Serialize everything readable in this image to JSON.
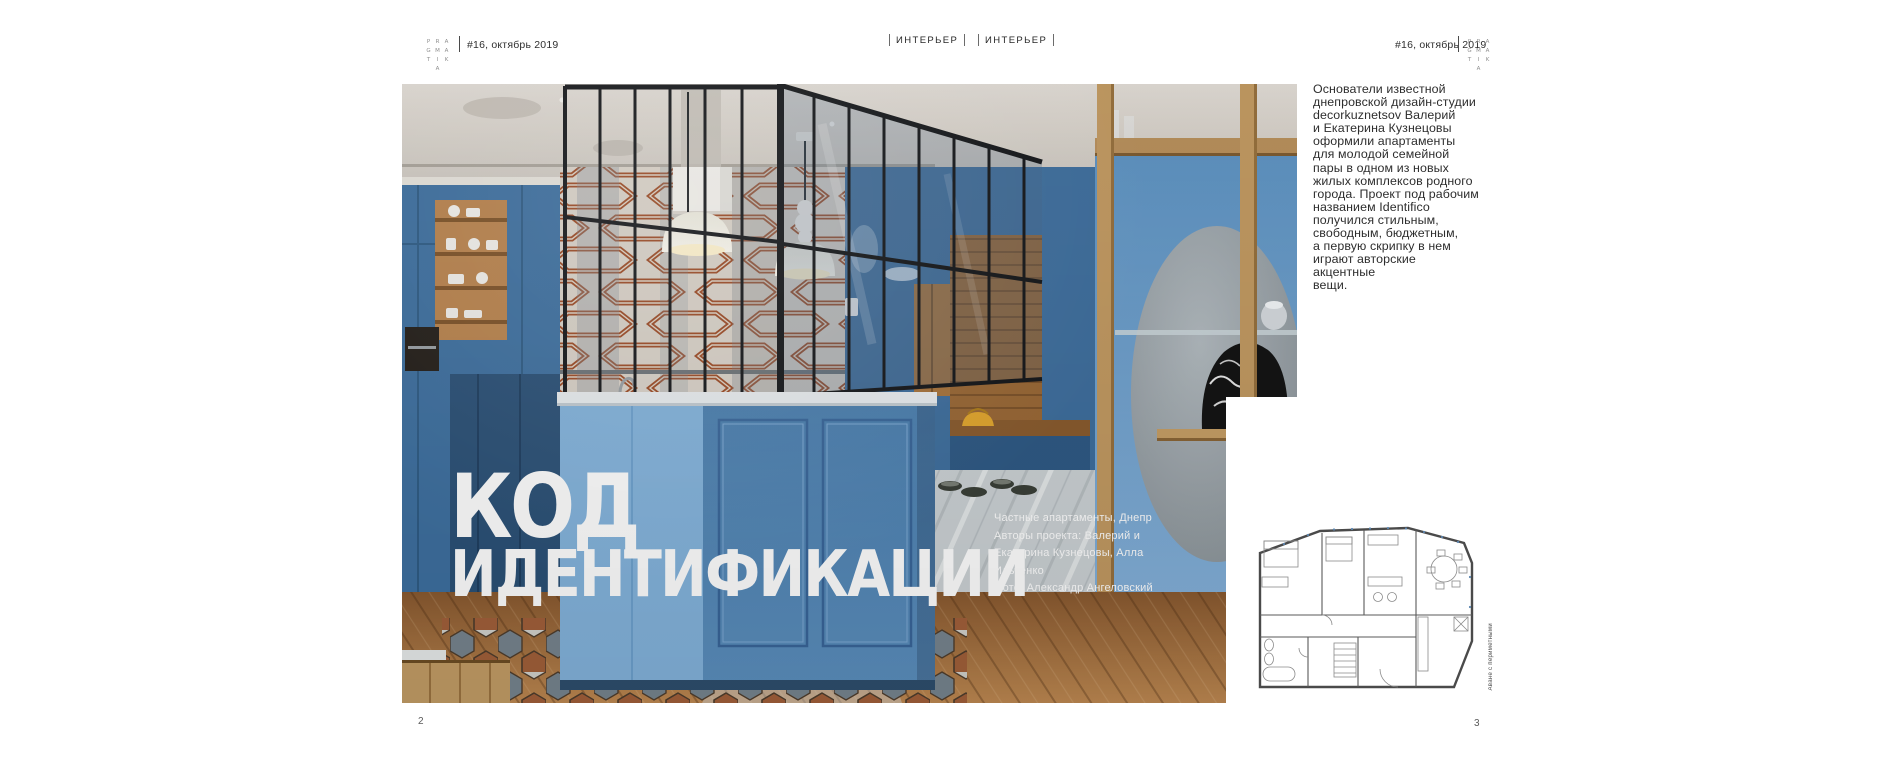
{
  "header": {
    "issue": "#16, октябрь 2019",
    "sections": [
      "ИНТЕРЬЕР",
      "ИНТЕРЬЕР"
    ],
    "logo_rows": [
      [
        "P",
        "R",
        "A"
      ],
      [
        "G",
        "M",
        "A"
      ],
      [
        "T",
        "I",
        "K"
      ],
      [
        "",
        "A",
        ""
      ]
    ]
  },
  "article": {
    "title_line1": "КОД",
    "title_line2": "ИДЕНТИФИКАЦИИ",
    "credits": [
      "Частные апартаменты, Днепр",
      "Авторы проекта: Валерий и",
      "Екатерина Кузнецовы, Алла",
      "Ильченко",
      "Фото: Александр Ангеловский"
    ],
    "intro_lines": [
      "Основатели известной",
      "днепровской дизайн-студии",
      "decorkuznetsov Валерий",
      "и Екатерина Кузнецовы",
      "оформили апартаменты",
      "для молодой семейной",
      "пары в одном из новых",
      "жилых комплексов родного",
      "города. Проект под рабочим",
      "названием Identifico",
      "получился стильным,",
      "свободным, бюджетным,",
      "а первую скрипку в нем",
      "играют авторские акцентные",
      "вещи."
    ]
  },
  "floor_plan": {
    "caption": "Аване с периметными"
  },
  "pages": {
    "left": "2",
    "right": "3"
  },
  "colors": {
    "cabinet_blue": "#4d81b1",
    "light_blue": "#84b4dd",
    "navy": "#2b5177",
    "wallpaper_rust": "#a04e28",
    "wood": "#c29a62",
    "floor_wood": "#a06a38",
    "bag_yellow": "#e2a72e"
  }
}
